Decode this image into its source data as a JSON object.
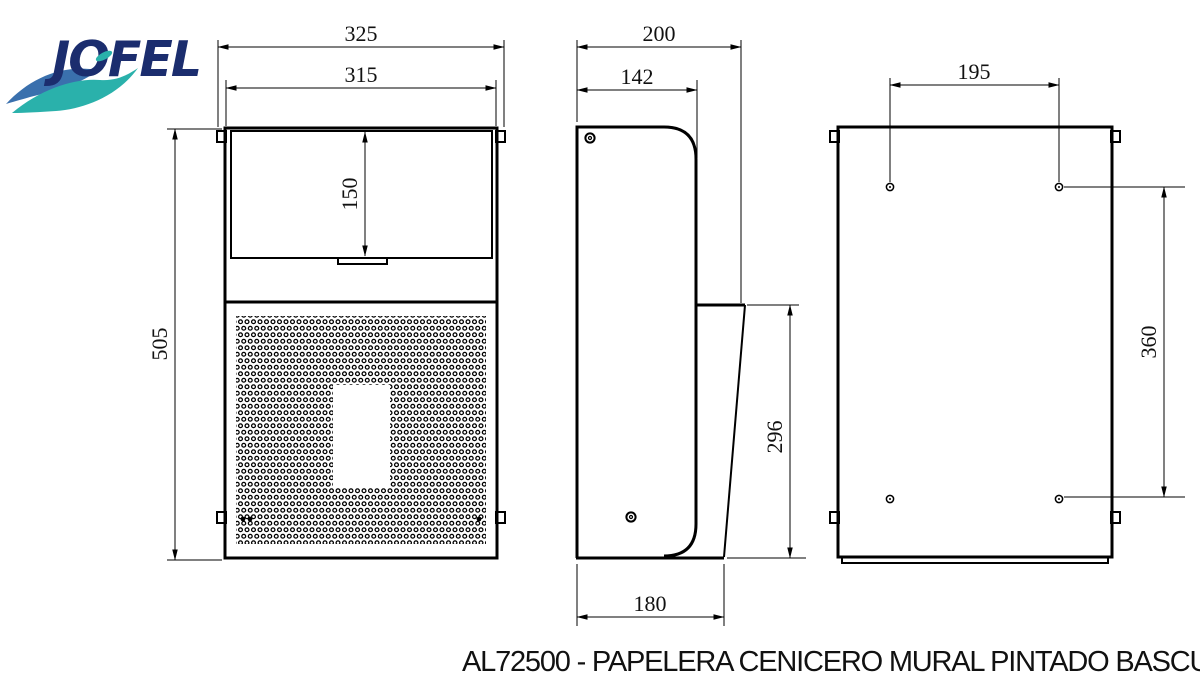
{
  "logo": {
    "text": "JOFEL"
  },
  "caption": "AL72500 - PAPELERA CENICERO MURAL PINTADO BASCULANTE",
  "colors": {
    "line": "#000000",
    "background": "#ffffff",
    "logo_navy": "#1b2d6e",
    "logo_blue": "#3a70ad",
    "logo_teal": "#2ab1ab"
  },
  "views": {
    "front": {
      "label": "front-view",
      "dimensions": {
        "overall_width": "325",
        "inner_width": "315",
        "flap_height": "150",
        "overall_height": "505"
      }
    },
    "side": {
      "label": "side-view",
      "dimensions": {
        "overall_depth": "200",
        "body_depth": "142",
        "swing_height": "296",
        "bottom_depth": "180"
      }
    },
    "back": {
      "label": "back-view",
      "dimensions": {
        "hole_spacing_horizontal": "195",
        "hole_spacing_vertical": "360"
      }
    }
  }
}
